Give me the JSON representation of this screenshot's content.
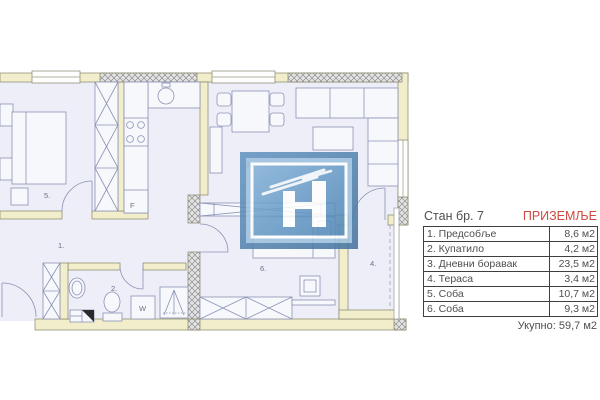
{
  "header": {
    "apartment": "Стан бр. 7",
    "floor": "ПРИЗЕМЉЕ"
  },
  "area_table": {
    "rows": [
      {
        "name": "1. Предсобље",
        "area": "8,6 м2"
      },
      {
        "name": "2. Купатило",
        "area": "4,2 м2"
      },
      {
        "name": "3. Дневни боравак",
        "area": "23,5 м2"
      },
      {
        "name": "4. Тераса",
        "area": "3,4 м2"
      },
      {
        "name": "5. Соба",
        "area": "10,7 м2"
      },
      {
        "name": "6. Соба",
        "area": "9,3 м2"
      }
    ],
    "total": "Укупно: 59,7 м2"
  },
  "plan": {
    "room_labels": {
      "hallway": "1.",
      "bathroom": "2.",
      "living_room": "3.",
      "terrace": "4.",
      "bedroom_5": "5.",
      "bedroom_6": "6."
    },
    "appliance_labels": {
      "fridge": "F",
      "washing_machine": "W"
    }
  },
  "colors": {
    "wall_fill": "#f2eecb",
    "floor_fill": "#edeef7",
    "furniture_line": "#8a92b4",
    "accent_red": "#cf4a3e",
    "table_border": "#3f3f3f",
    "logo_outer_blue": "#5484b3",
    "logo_light_blue": "#9cc0de",
    "logo_panel_blue": "#6397c5"
  }
}
